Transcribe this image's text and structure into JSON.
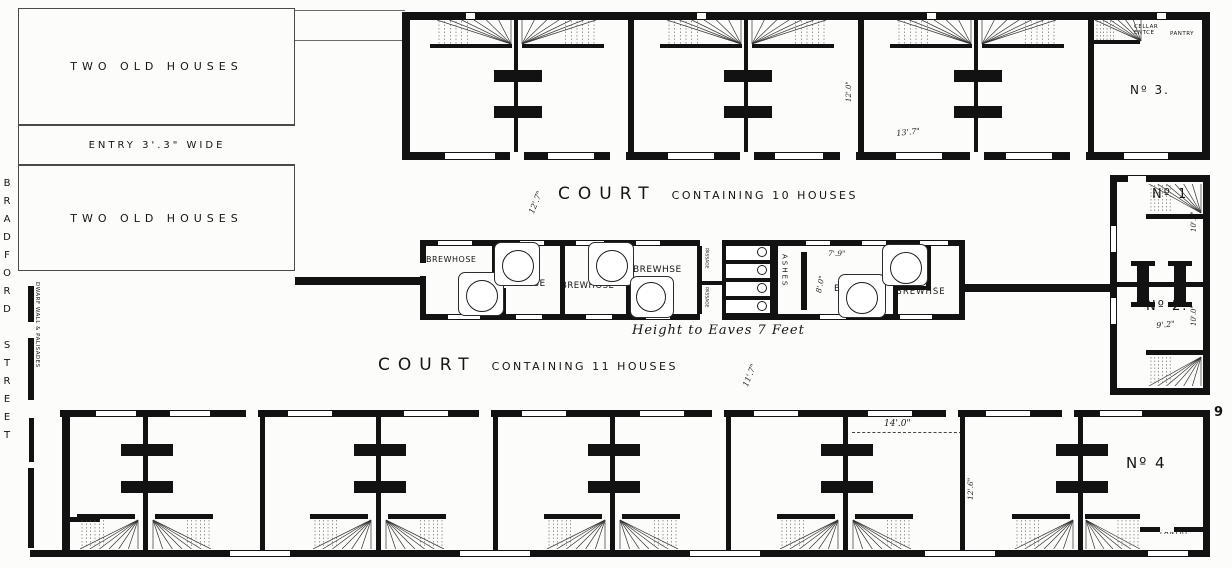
{
  "left_column": {
    "upper": "TWO OLD HOUSES",
    "entry": "ENTRY 3'.3\" WIDE",
    "lower": "TWO OLD HOUSES"
  },
  "street": {
    "name": "BRADFORD STREET",
    "palisade": "DWARF WALL & PALISADES"
  },
  "courts": {
    "upper_big": "COURT",
    "upper_small": "CONTAINING 10 HOUSES",
    "upper_dim": "12'.7\"",
    "lower_big": "COURT",
    "lower_small": "CONTAINING 11 HOUSES",
    "lower_dim": "11'.7\""
  },
  "notes": {
    "eaves": "Height to Eaves 7 Feet"
  },
  "rooms": {
    "no1": "Nº 1",
    "no2": "Nº 2.",
    "no3": "Nº 3.",
    "no4": "Nº 4",
    "cellar1": "CELLAR",
    "cellar2": "ENTCE",
    "pantry_top": "PANTRY",
    "pantry_bottom": "PANTRY",
    "ashes": "ASHES",
    "passage1": "PASSAGE",
    "passage2": "PASSAGE"
  },
  "brewhouses": [
    "BREWHOSE",
    "BREWHSE",
    "BREWHOSE",
    "BREWHSE",
    "BREWHSE",
    "BREWHSE"
  ],
  "privies": [
    "PRIVY",
    "PRIVY",
    "PRIVY",
    "PRIVY"
  ],
  "dims": {
    "top_v": "12'.0\"",
    "top_h": "13'.7\"",
    "brew_w": "7'.9\"",
    "brew_h": "8'.0\"",
    "no1_h": "10'.0\"",
    "no2_h": "10'.0\"",
    "no2_w": "9'.2\"",
    "bottom_w": "14'.0\"",
    "bottom_v": "12'.6\"",
    "edge_mark": "9"
  }
}
